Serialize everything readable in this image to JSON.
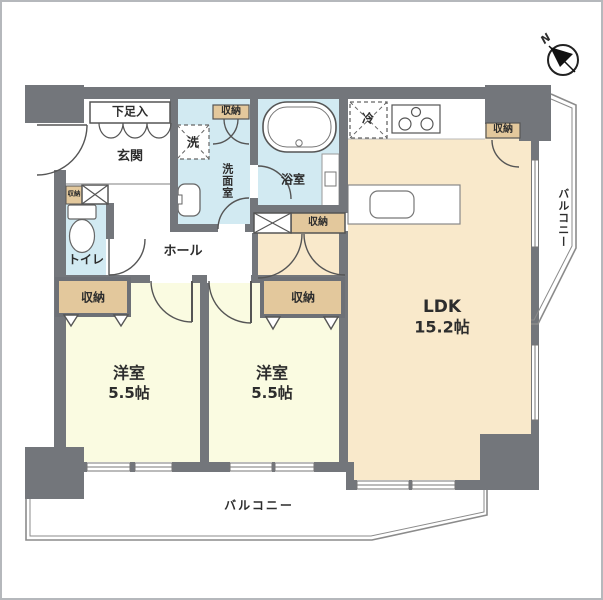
{
  "compass": {
    "north_label": "N"
  },
  "rooms": {
    "ldk": {
      "name": "LDK",
      "size": "15.2帖"
    },
    "bedroom1": {
      "name": "洋室",
      "size": "5.5帖"
    },
    "bedroom2": {
      "name": "洋室",
      "size": "5.5帖"
    },
    "entrance": {
      "name": "玄関"
    },
    "hall": {
      "name": "ホール"
    },
    "toilet": {
      "name": "トイレ"
    },
    "washroom": {
      "name": "洗面室"
    },
    "bathroom": {
      "name": "浴室"
    },
    "shoe_cabinet": {
      "name": "下足入"
    }
  },
  "labels": {
    "storage": "収納",
    "washer": "洗",
    "refrigerator": "冷",
    "balcony": "バルコニー"
  },
  "colors": {
    "wall": "#73767b",
    "ldk_floor": "#f9e9cb",
    "bedroom_floor": "#fafbe1",
    "wet_floor": "#d2eaf2",
    "closet": "#e3c89c",
    "balcony_line": "#8b8b8b",
    "text": "#2d2d2d"
  }
}
